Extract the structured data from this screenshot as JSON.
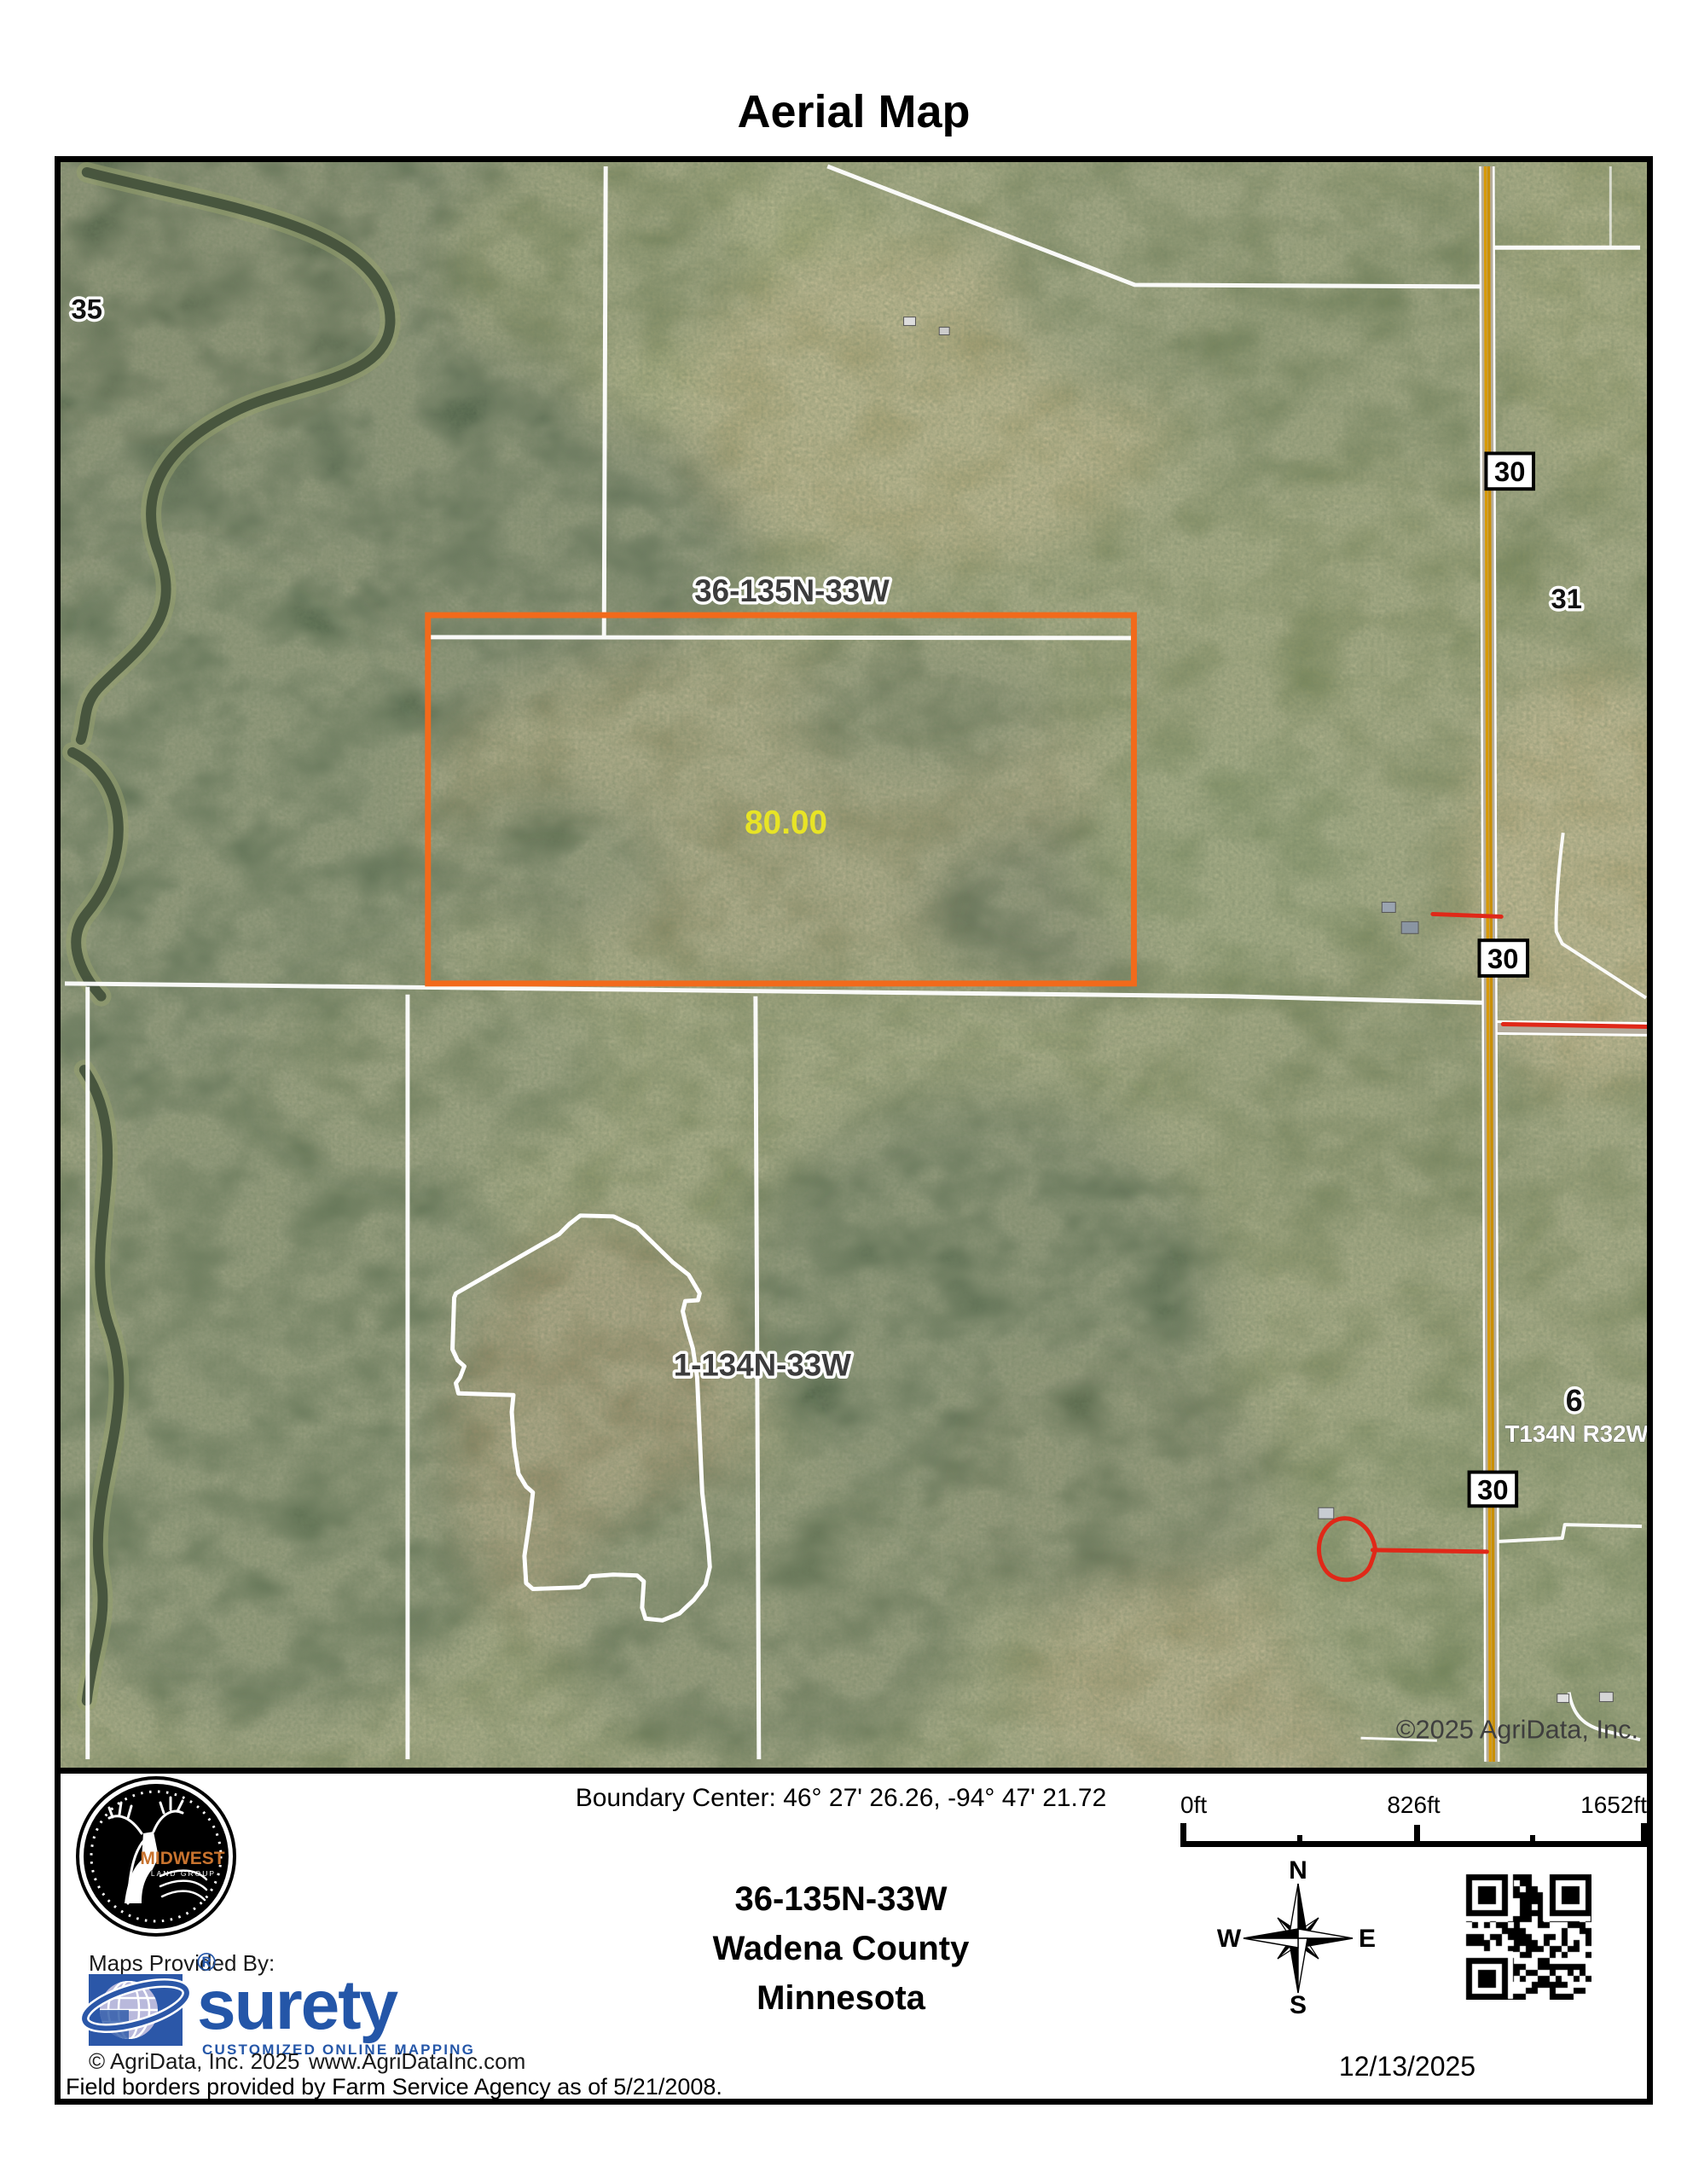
{
  "title": "Aerial Map",
  "map": {
    "labels": {
      "sec35": "35",
      "sec36": "36-135N-33W",
      "sec31": "31",
      "sec1": "1-134N-33W",
      "sec6": "6",
      "township_right": "T134N R32W",
      "acreage": "80.00",
      "highway_shield": "30",
      "copyright": "©2025 AgriData, Inc."
    },
    "colors": {
      "parcel_outline": "#F26A1B",
      "acreage_text": "#E8E426",
      "annotation_red": "#E02818",
      "section_line": "#FFFFFF"
    }
  },
  "footer": {
    "boundary_center": "Boundary Center: 46° 27' 26.26,  -94° 47' 21.72",
    "location": {
      "section": "36-135N-33W",
      "county": "Wadena County",
      "state": "Minnesota"
    },
    "scale_bar": {
      "tick0": "0ft",
      "tick1": "826ft",
      "tick2": "1652ft"
    },
    "compass": {
      "n": "N",
      "s": "S",
      "e": "E",
      "w": "W"
    },
    "date": "12/13/2025",
    "logo": {
      "brand": "MIDWEST",
      "brand_sub": "LAND GROUP"
    },
    "provider": {
      "label": "Maps Provided By:",
      "name": "surety",
      "registered": "®",
      "tagline": "CUSTOMIZED ONLINE MAPPING",
      "copyright": "© AgriData, Inc. 2025",
      "website": "www.AgriDataInc.com"
    },
    "disclaimer": "Field borders provided by Farm Service Agency as of 5/21/2008."
  }
}
